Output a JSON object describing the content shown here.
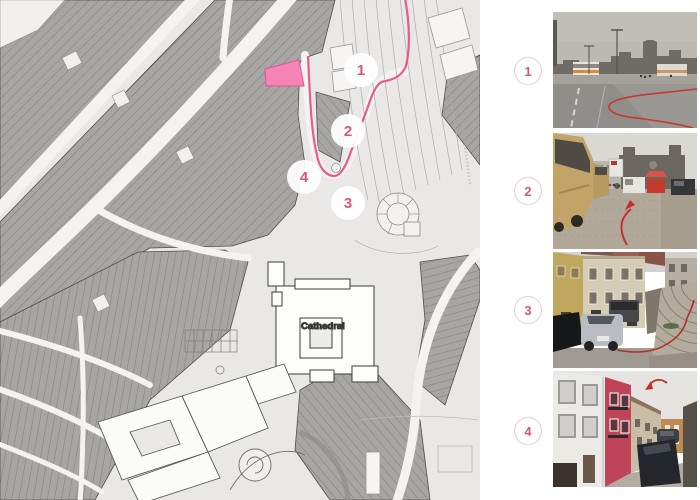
{
  "map": {
    "cathedral_label": "Cathedral",
    "markers": [
      {
        "number": "1"
      },
      {
        "number": "2"
      },
      {
        "number": "3"
      },
      {
        "number": "4"
      }
    ],
    "colors": {
      "route": "#e8537f",
      "highlight_building": "#f583b4",
      "marker_number": "#d6577b",
      "building_gray": "#a7a6a4",
      "street_white": "#f4f3f1",
      "background": "#e9e8e6"
    }
  },
  "panel": {
    "items": [
      {
        "number": "1",
        "image": "road-with-buses-near-cathedral"
      },
      {
        "number": "2",
        "image": "tour-bus-on-cobbled-square"
      },
      {
        "number": "3",
        "image": "street-parked-cars-stone-steps"
      },
      {
        "number": "4",
        "image": "narrow-street-red-house"
      }
    ],
    "sketch_red": "#c23028"
  }
}
